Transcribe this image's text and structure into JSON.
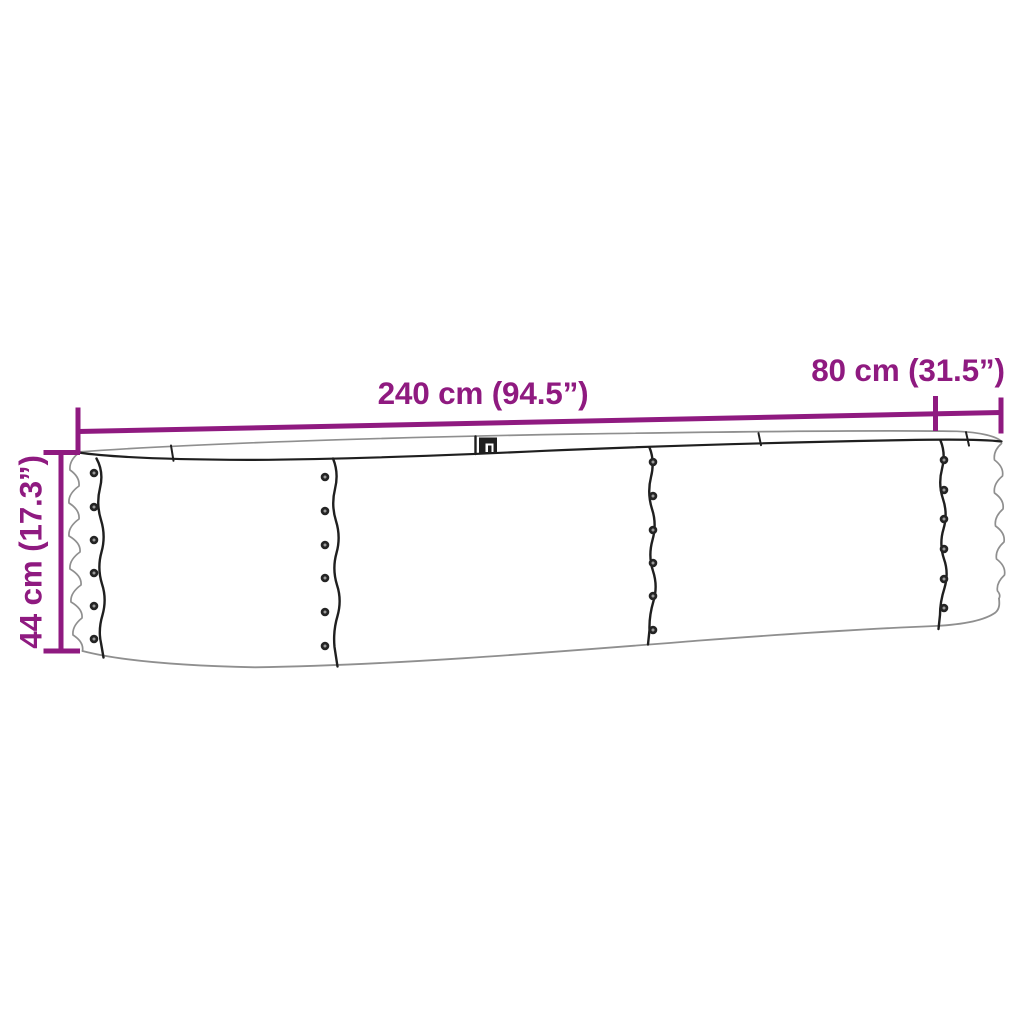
{
  "diagram": {
    "type": "product-dimension-diagram",
    "subject": "oval metal raised garden bed",
    "labels": {
      "length": "240 cm (94.5”)",
      "width": "80 cm (31.5”)",
      "height": "44 cm (17.3”)"
    },
    "colors": {
      "accent": "#8f1a80",
      "ink": "#1f1f1f",
      "soft": "#8f8f8f",
      "bg": "#ffffff"
    }
  }
}
